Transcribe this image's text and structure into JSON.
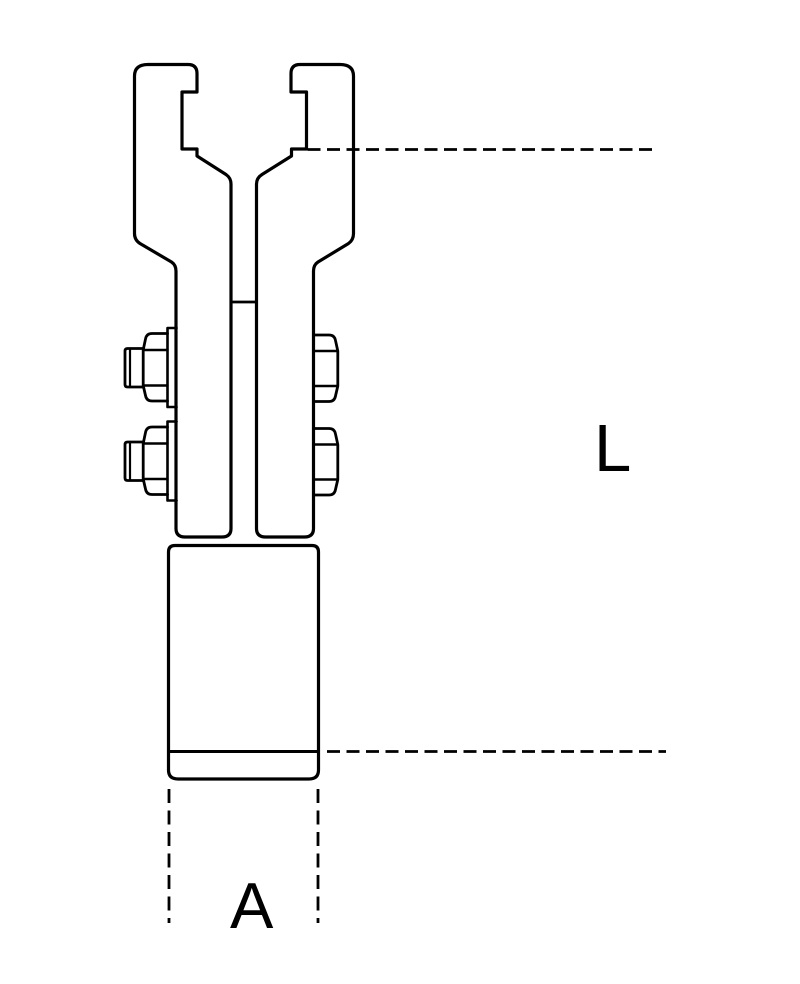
{
  "figure": {
    "background_color": "#ffffff",
    "line_color": "#000000",
    "parts": [
      "left-jaw",
      "right-jaw",
      "jaw-slot-crossbar",
      "left-fixing-bolt-top",
      "left-fixing-bolt-bottom",
      "right-fixing-nut-top",
      "right-fixing-nut-bottom",
      "cylindrical-shank",
      "dimension-line-L-top",
      "dimension-line-L-bottom",
      "extension-line-left",
      "extension-line-right"
    ],
    "dimensions": {
      "L": {
        "label": "L"
      },
      "A": {
        "label": "A"
      }
    }
  }
}
